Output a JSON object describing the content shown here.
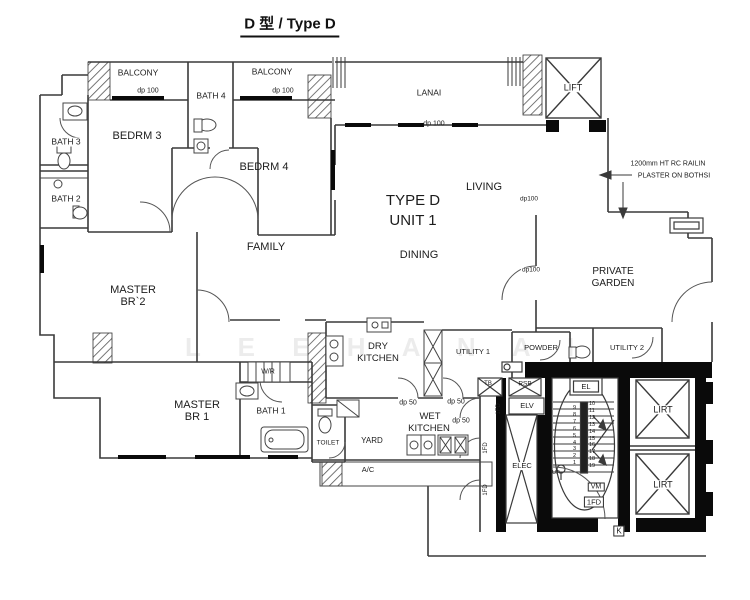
{
  "title": "D 型 / Type D",
  "rooms": {
    "balcony_left": "BALCONY",
    "bath4": "BATH 4",
    "balcony_right": "BALCONY",
    "bedrm3": "BEDRM 3",
    "bedrm4": "BEDRM 4",
    "bath3": "BATH 3",
    "bath2": "BATH 2",
    "lanai": "LANAI",
    "lift_top": "LIFT",
    "living": "LIVING",
    "unit_line1": "TYPE D",
    "unit_line2": "UNIT 1",
    "dining": "DINING",
    "family": "FAMILY",
    "master_br2_line1": "MASTER",
    "master_br2_line2": "BR`2",
    "private_garden_line1": "PRIVATE",
    "private_garden_line2": "GARDEN",
    "dry_kitchen_line1": "DRY",
    "dry_kitchen_line2": "KITCHEN",
    "utility1": "UTILITY 1",
    "powder": "POWDER",
    "utility2": "UTILITY 2",
    "wr": "W/R",
    "master_br1_line1": "MASTER",
    "master_br1_line2": "BR 1",
    "bath1": "BATH 1",
    "toilet": "TOILET",
    "yard": "YARD",
    "wet_kitchen_line1": "WET",
    "wet_kitchen_line2": "KITCHEN",
    "ac": "A/C",
    "elec": "ELEC",
    "lift_mid": "LIRT",
    "lift_bottom": "LIRT"
  },
  "annotations": {
    "railing_line1": "1200mm HT RC RAILIN",
    "railing_line2": "PLASTER ON BOTHSI",
    "dp100_balcony_left": "dp 100",
    "dp100_balcony_right": "dp 100",
    "dp100_lanai": "dp 100",
    "dp100_living": "dp100",
    "dp100_garden": "dp100",
    "dp50_dry_left": "dp 50",
    "dp50_dry_right": "dp 50",
    "dp50_wet": "dp 50",
    "el": "EL",
    "elv": "ELV",
    "rsb": "RSB",
    "tb": "TB",
    "vm": "VM",
    "fd": "1FD",
    "k": "K",
    "up": "UP",
    "fd_door_1": "1FD",
    "fd_door_2": "1FD",
    "fd_door_3": "1FD"
  },
  "stair": {
    "numbers_left": "9\n8\n7\n6\n5\n4\n3\n2\n1",
    "numbers_right": "10\n11\n12\n13\n14\n15\n16\n17\n18\n19"
  },
  "watermark": "L E E  H A N  A I",
  "colors": {
    "line": "#3a3a3a",
    "wall_black": "#0a0a0a",
    "paper": "#ffffff"
  }
}
